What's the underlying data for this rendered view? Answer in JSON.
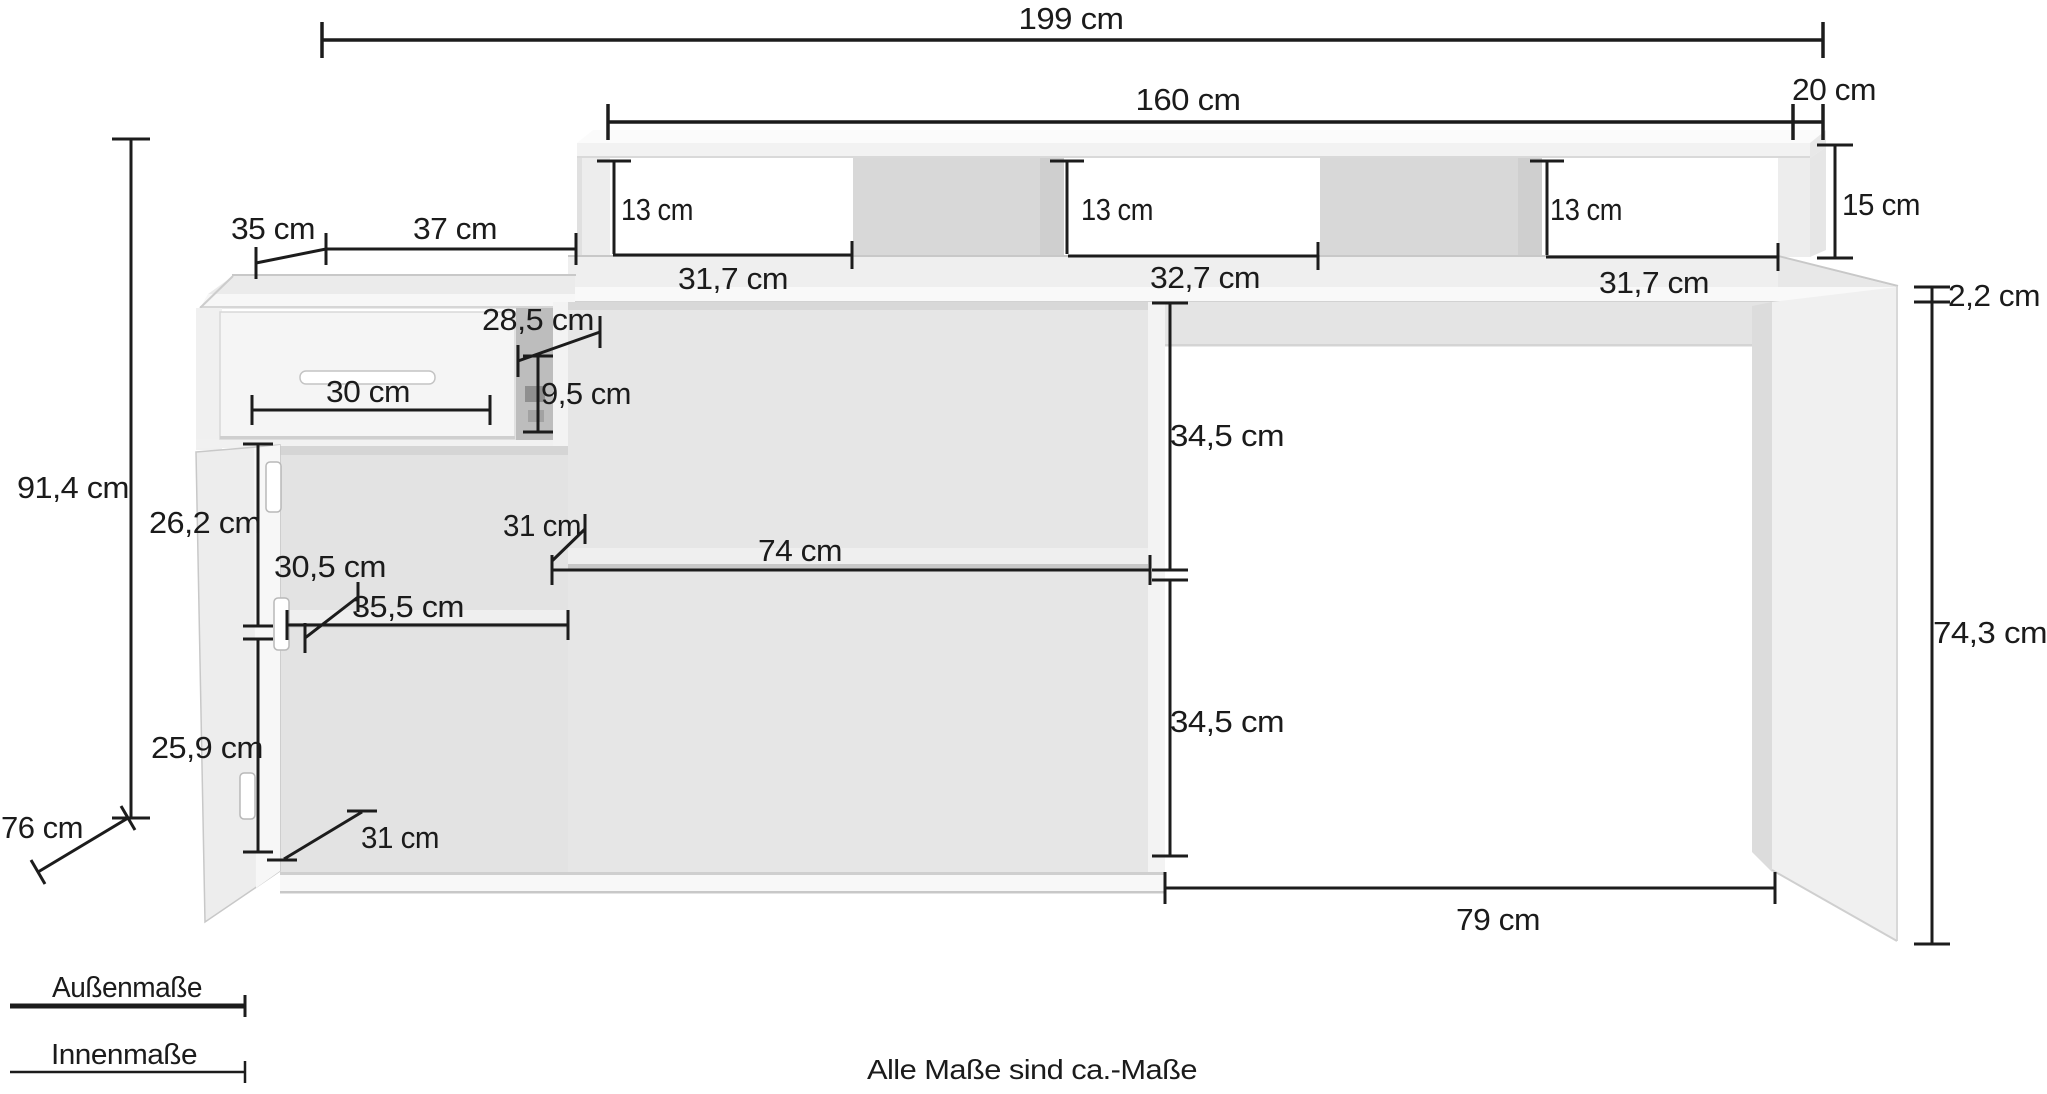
{
  "diagram": {
    "type": "furniture-dimension-drawing",
    "subject": "desk-with-sideboard-and-monitor-riser",
    "unit": "cm",
    "note": "Alle Maße sind ca.-Maße",
    "legend": {
      "outer": "Außenmaße",
      "inner": "Innenmaße"
    },
    "colors": {
      "background": "#ffffff",
      "line": "#1c1c1c",
      "text": "#1b1b1b",
      "furniture_light": "#f5f5f5",
      "furniture_mid": "#e6e6e6",
      "furniture_dark": "#d8d8d8",
      "niche_dark": "#bdbdbd"
    },
    "measurements": {
      "total_width": "199 cm",
      "riser_width": "160 cm",
      "riser_depth": "20 cm",
      "riser_height": "15 cm",
      "cubby_heights": [
        "13 cm",
        "13 cm",
        "13 cm"
      ],
      "cubby_widths": [
        "31,7 cm",
        "32,7 cm",
        "31,7 cm"
      ],
      "desktop_thickness": "2,2 cm",
      "sideboard_left_depth": "35 cm",
      "sideboard_top_width": "37 cm",
      "overhang_depth": "28,5 cm",
      "niche_height": "9,5 cm",
      "drawer_width": "30 cm",
      "total_height": "91,4 cm",
      "door_section_heights": [
        "26,2 cm",
        "25,9 cm"
      ],
      "left_shelf_depth": "30,5 cm",
      "left_shelf_width": "35,5 cm",
      "middle_shelf_depth": "31 cm",
      "middle_compartment_width": "74 cm",
      "bottom_shelf_depth": "31 cm",
      "kneehole_section_heights": [
        "34,5 cm",
        "34,5 cm"
      ],
      "kneehole_width": "79 cm",
      "desk_clearance_height": "74,3 cm",
      "desk_depth": "76 cm"
    },
    "annotations": [
      {
        "id": "total-width",
        "text": "199 cm"
      },
      {
        "id": "riser-width",
        "text": "160 cm"
      },
      {
        "id": "riser-depth",
        "text": "20 cm"
      },
      {
        "id": "sideboard-left-depth",
        "text": "35 cm"
      },
      {
        "id": "sideboard-top-width",
        "text": "37 cm"
      },
      {
        "id": "cubby-left-height",
        "text": "13 cm"
      },
      {
        "id": "cubby-middle-height",
        "text": "13 cm"
      },
      {
        "id": "cubby-right-height",
        "text": "13 cm"
      },
      {
        "id": "riser-height",
        "text": "15 cm"
      },
      {
        "id": "cubby-left-width",
        "text": "31,7 cm"
      },
      {
        "id": "cubby-middle-width",
        "text": "32,7 cm"
      },
      {
        "id": "cubby-right-width",
        "text": "31,7 cm"
      },
      {
        "id": "desktop-thickness",
        "text": "2,2 cm"
      },
      {
        "id": "overhang-depth",
        "text": "28,5 cm"
      },
      {
        "id": "niche-height",
        "text": "9,5 cm"
      },
      {
        "id": "drawer-width",
        "text": "30 cm"
      },
      {
        "id": "total-height",
        "text": "91,4 cm"
      },
      {
        "id": "kneehole-upper-height",
        "text": "34,5 cm"
      },
      {
        "id": "door-upper-height",
        "text": "26,2 cm"
      },
      {
        "id": "shelf-depth-left",
        "text": "30,5 cm"
      },
      {
        "id": "shelf-depth-middle",
        "text": "31 cm"
      },
      {
        "id": "middle-compartment-width",
        "text": "74 cm"
      },
      {
        "id": "left-shelf-width",
        "text": "35,5 cm"
      },
      {
        "id": "desk-clearance-height",
        "text": "74,3 cm"
      },
      {
        "id": "door-lower-height",
        "text": "25,9 cm"
      },
      {
        "id": "kneehole-lower-height",
        "text": "34,5 cm"
      },
      {
        "id": "bottom-shelf-depth",
        "text": "31 cm"
      },
      {
        "id": "desk-depth",
        "text": "76 cm"
      },
      {
        "id": "kneehole-width",
        "text": "79 cm"
      },
      {
        "id": "legend-outer",
        "text": "Außenmaße"
      },
      {
        "id": "legend-inner",
        "text": "Innenmaße"
      },
      {
        "id": "footnote",
        "text": "Alle Maße sind ca.-Maße"
      }
    ]
  }
}
